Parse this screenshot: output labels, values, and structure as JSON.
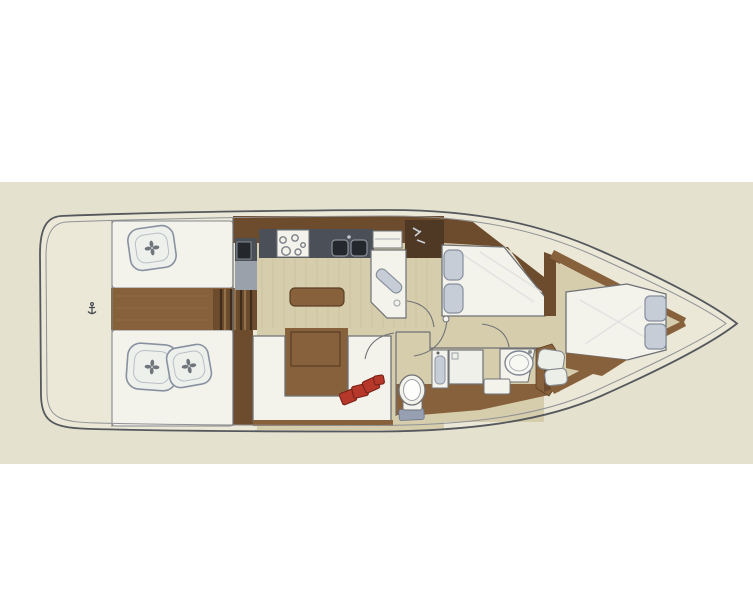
{
  "title": "Sailing yacht interior layout plan (top-down, bow to the right)",
  "colors": {
    "page_bg": "#ffffff",
    "plan_bg": "#e5e1cd",
    "deck": "#ebe8d7",
    "hull_outline": "#55585c",
    "hull_inner": "#8f9294",
    "bulkhead": "#6f7276",
    "wood_dark": "#6f4c2a",
    "wood_mid": "#8a6137",
    "wood_shadow": "#5c3f23",
    "step_dark": "#3f2d1b",
    "step_light": "#b08a5a",
    "floor_light": "#d7cda9",
    "floor_grain": "#c7bb94",
    "walkway_grain": "#a0763f",
    "counter_dark": "#4a4f59",
    "counter_inset": "#24282d",
    "counter_light": "#99a1ac",
    "surface_white": "#f3f2ea",
    "sheen": "#dcdee0",
    "cushion_blue": "#c7cdd8",
    "cushion_outline": "#8791a1",
    "flower_dark": "#596068",
    "accent_red": "#bf3627",
    "accent_red_dark": "#7e1f15",
    "mat_blue": "#96a0b5",
    "mark_light": "#ccd2da"
  },
  "areas": {
    "aft_deck": {
      "name": "aft-deck-transom"
    },
    "cockpit": {
      "name": "cockpit",
      "benches": 2,
      "seat_cushions": 3
    },
    "companionway": {
      "name": "companionway-steps",
      "steps": 3
    },
    "galley": {
      "name": "galley",
      "burners": 5,
      "sink_basins": 2
    },
    "saloon": {
      "name": "saloon",
      "tables": 2,
      "red_cushions": 4,
      "settee": "U-shaped"
    },
    "wet_locker": {
      "name": "wet-locker-seat"
    },
    "aft_head": {
      "name": "aft-head",
      "toilets": 1,
      "showers": 1,
      "wash_basins": 1
    },
    "mid_cabin": {
      "name": "midship-double-cabin",
      "pillows": 2
    },
    "fwd_cabin": {
      "name": "forward-v-berth-cabin",
      "pillows": 2
    }
  }
}
